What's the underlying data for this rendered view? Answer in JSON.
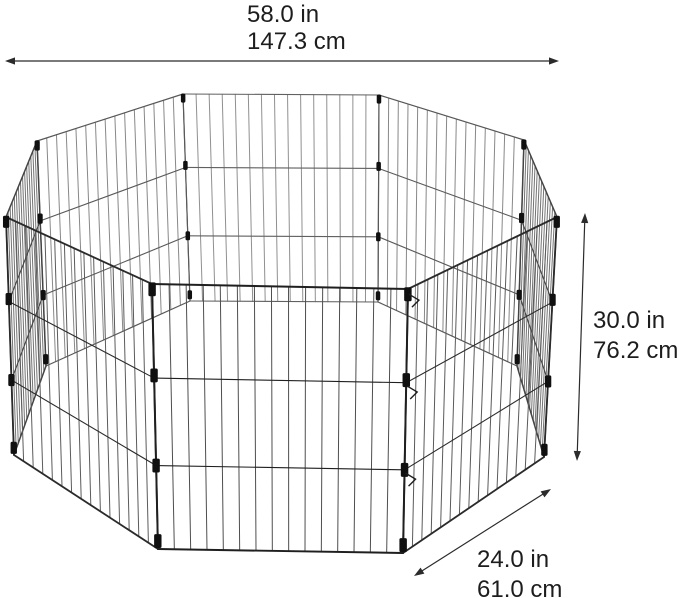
{
  "illustration": {
    "name": "octagonal-wire-pet-exercise-pen",
    "panel_count": 8
  },
  "dimensions": {
    "width": {
      "inches": "58.0 in",
      "centimeters": "147.3 cm"
    },
    "height": {
      "inches": "30.0 in",
      "centimeters": "76.2 cm"
    },
    "panel_width": {
      "inches": "24.0 in",
      "centimeters": "61.0 cm"
    }
  },
  "colors": {
    "background": "#ffffff",
    "text": "#1d1d1d",
    "arrow": "#2b2b2b",
    "frame_near": "#1e1e1e",
    "frame_far": "#606060",
    "wire_near": "#4d4d4d",
    "wire_far": "#909090",
    "clip": "#101010"
  }
}
